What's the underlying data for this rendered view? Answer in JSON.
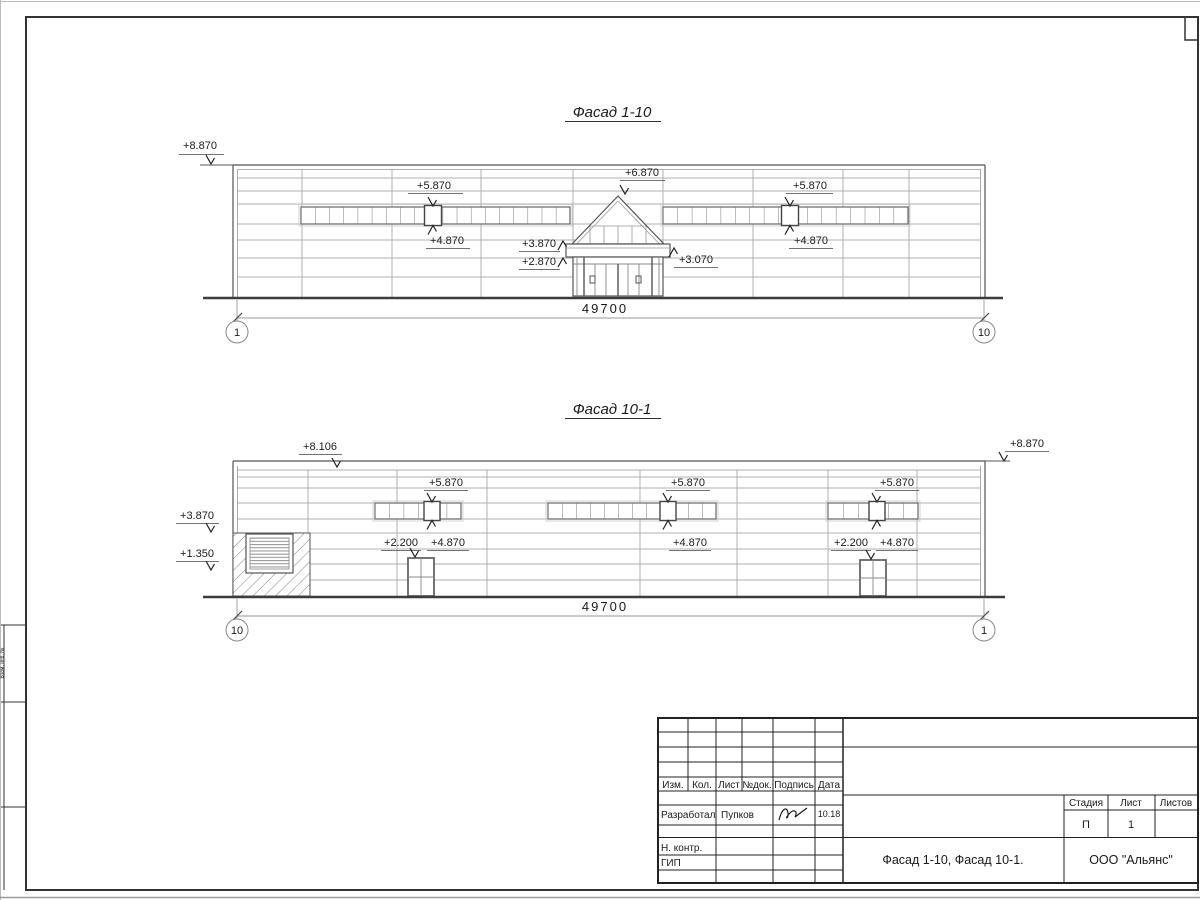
{
  "sheet": {
    "dimension": "49700"
  },
  "levels": {
    "h8870": "+8.870",
    "h8106": "+8.106",
    "h6870": "+6.870",
    "h5870": "+5.870",
    "h4870": "+4.870",
    "h3870": "+3.870",
    "h2870": "+2.870",
    "h3070": "+3.070",
    "h2200": "+2.200",
    "h1350": "+1.350"
  },
  "facade_top": {
    "title": "Фасад 1-10",
    "grid_left": "1",
    "grid_right": "10"
  },
  "facade_bottom": {
    "title": "Фасад 10-1",
    "grid_left": "10",
    "grid_right": "1"
  },
  "title_block": {
    "col_headers": {
      "izm": "Изм.",
      "kol": "Кол.",
      "list": "Лист",
      "ndok": "№док.",
      "podp": "Подпись",
      "data": "Дата"
    },
    "developed_label": "Разработал",
    "developed_name": "Пупков",
    "date_value": "10.18",
    "ncontr_label": "Н. контр.",
    "gip_label": "ГИП",
    "doc_title": "Фасад 1-10, Фасад 10-1.",
    "company": "ООО \"Альянс\"",
    "stage_label": "Стадия",
    "sheet_label": "Лист",
    "sheets_label": "Листов",
    "stage_value": "П",
    "sheet_value": "1"
  },
  "frame": {
    "side_label": "Взам. инв. №"
  }
}
